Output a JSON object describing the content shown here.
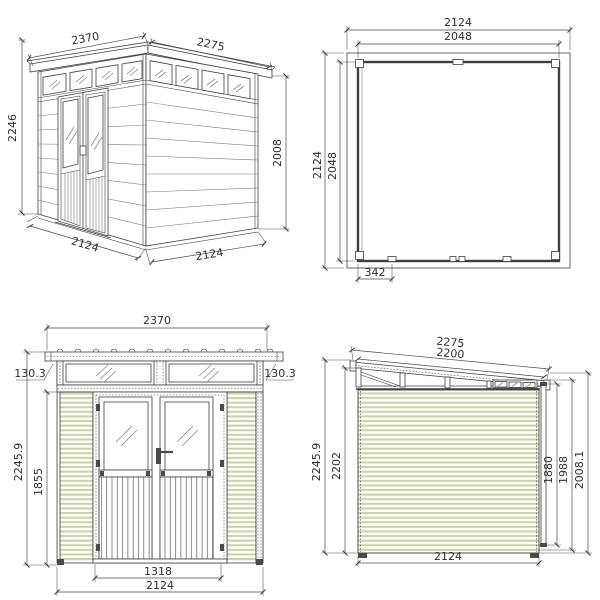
{
  "drawing": {
    "type": "shed-technical-drawing",
    "colors": {
      "line": "#3f3f3f",
      "siding_stripe": "#ccd1a8",
      "background": "#ffffff"
    },
    "views": {
      "perspective": {
        "dims": {
          "roof_width_front": "2370",
          "roof_depth_side": "2275",
          "height_left": "2246",
          "height_right": "2008",
          "base_width_front": "2124",
          "base_depth_side": "2124"
        }
      },
      "plan": {
        "dims": {
          "outer_width": "2124",
          "inner_width": "2048",
          "outer_depth": "2124",
          "inner_depth": "2048",
          "door_offset": "342"
        }
      },
      "front": {
        "dims": {
          "roof_width": "2370",
          "overhang_left": "130.3",
          "overhang_right": "130.3",
          "height_total": "2245.9",
          "height_wall": "1855",
          "door_width": "1318",
          "wall_width": "2124"
        }
      },
      "side": {
        "dims": {
          "roof_length": "2275",
          "roof_inner_length": "2200",
          "height_total": "2245.9",
          "height_front_wall": "2202",
          "height_rear_clear": "1880",
          "height_rear_mid": "1988",
          "height_rear_wall": "2008.1",
          "base_depth": "2124"
        }
      }
    }
  }
}
